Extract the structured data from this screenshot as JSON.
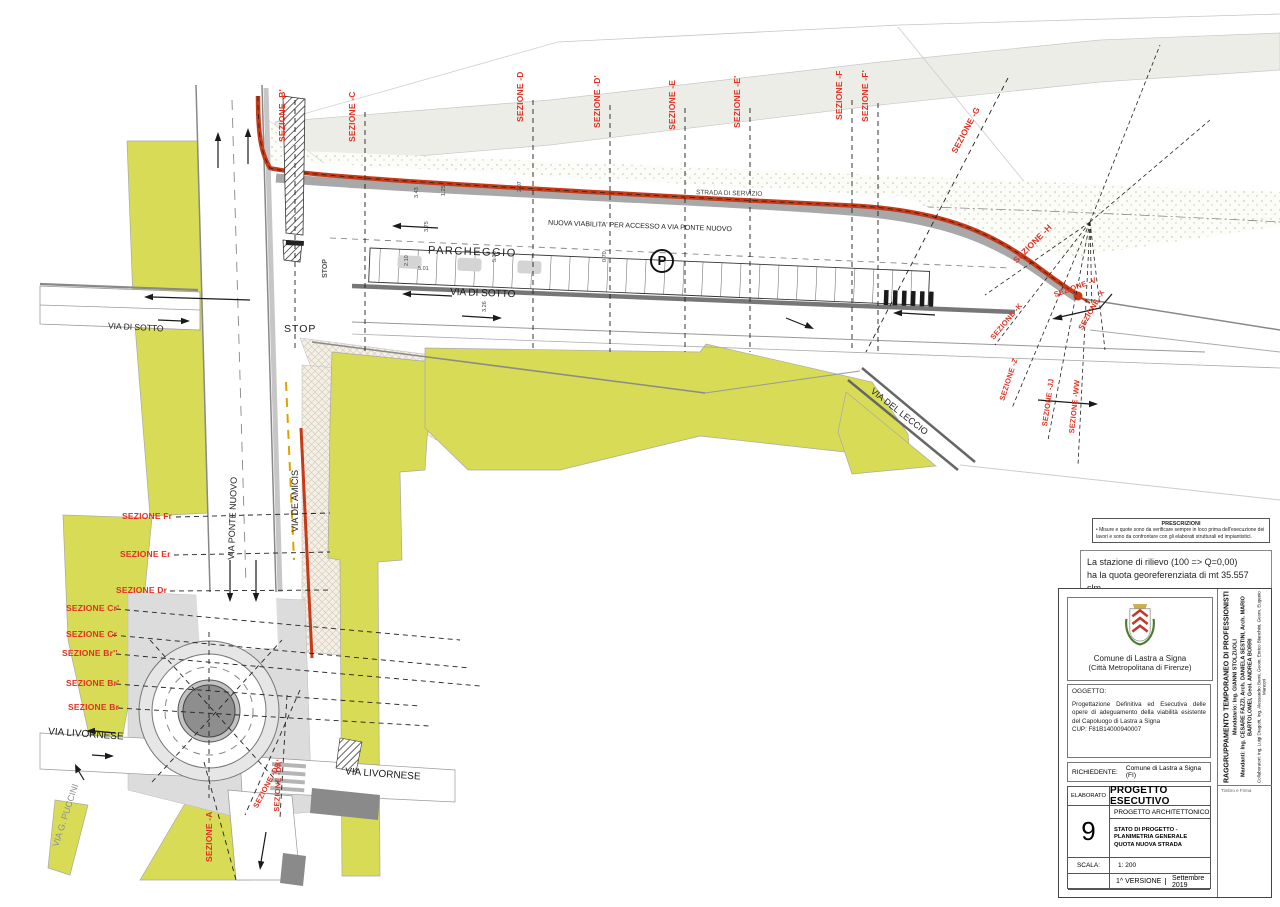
{
  "colors": {
    "section_red": "#e03224",
    "new_road_red": "#c63a17",
    "parcel_yellow": "#d7db55",
    "road_gray": "#a8a8a8",
    "terrain_gray": "#ededE8"
  },
  "streets": {
    "via_di_sotto": "VIA DI SOTTO",
    "stop": "STOP",
    "via_ponte_nuovo": "VIA PONTE NUOVO",
    "via_de_amicis": "VIA DE AMICIS",
    "strada_di_servizio": "STRADA DI SERVIZIO",
    "nuova_viabilita": "NUOVA VIABILITA' PER ACCESSO A VIA PONTE NUOVO",
    "parcheggio": "PARCHEGGIO",
    "parking_symbol": "P",
    "via_del_leccio": "VIA DEL LECCIO",
    "via_livornese": "VIA LIVORNESE",
    "via_g_puccini": "VIA G. PUCCINI"
  },
  "sections": {
    "top": [
      "SEZIONE -B'",
      "SEZIONE -C",
      "SEZIONE -D",
      "SEZIONE -D'",
      "SEZIONE -E",
      "SEZIONE -E'",
      "SEZIONE -F",
      "SEZIONE -F'",
      "SEZIONE -G"
    ],
    "right": [
      "SEZIONE -H",
      "SEZIONE -V",
      "SEZIONE -X",
      "SEZIONE -K",
      "SEZIONE -Z",
      "SEZIONE -JJ",
      "SEZIONE -WW"
    ],
    "left": [
      "SEZIONE Fr",
      "SEZIONE Er",
      "SEZIONE Dr",
      "SEZIONE Cr'",
      "SEZIONE Cr",
      "SEZIONE Br''",
      "SEZIONE Br'",
      "SEZIONE Br"
    ],
    "bottom": [
      "SEZIONE -A",
      "SEZIONE -DE",
      "SEZIONE -DA'"
    ]
  },
  "dimensions": [
    "3.43",
    "1.25",
    "2.07",
    "3.75",
    "2.10",
    "5.01",
    "5.36",
    "0.70",
    "3.26"
  ],
  "notes": {
    "prescrizioni_title": "PRESCRIZIONI",
    "prescrizioni_body": "• Misure e quote sono da verificare sempre in loco prima dell'esecuzione dei lavori e sono da confrontare con gli elaborati strutturali ed impiantistici.",
    "station_line1": "La stazione di rilievo (100 => Q=0,00)",
    "station_line2": "ha la quota georeferenziata di mt 35.557 slm"
  },
  "title_block": {
    "municipality": "Comune di Lastra a Signa",
    "municipality_sub": "(Città Metropolitana di Firenze)",
    "oggetto_label": "OGGETTO:",
    "oggetto_text": "Progettazione Definitiva ed Esecutiva delle opere di adeguamento della viabilità esistente del Capoluogo di Lastra a Signa",
    "cup": "CUP: F81B14000940007",
    "richiedente_label": "RICHIEDENTE:",
    "richiedente_value": "Comune di Lastra a Signa  (FI)",
    "elaborato_label": "ELABORATO",
    "project_title": "PROGETTO ESECUTIVO",
    "project_subtitle": "PROGETTO ARCHITETTONICO",
    "sheet_number": "9",
    "sheet_title_lines": [
      "STATO DI PROGETTO -",
      "PLANIMETRIA GENERALE",
      "QUOTA NUOVA STRADA"
    ],
    "scala_label": "SCALA:",
    "scala_value": "1: 200",
    "version": "1^ VERSIONE",
    "date": "Settembre 2019",
    "team": [
      "RAGGRUPPAMENTO TEMPORANEO DI PROFESSIONISTI",
      "Mandatario: Ing. GIANNI STOLZUOLI",
      "Mandanti: Ing. CESARE FAZZI, Arch. DANIELA SESTINI, Arch. MARIO BARTOLOMEI, Geol. ANDREA BORRI",
      "Collaboratori: Ing. Luigi Dragotti, Ing. Alessandro Berni, Geom. Enrico Bianchini, Geom. Eugenio Mancori"
    ],
    "timbro": "Timbro e Firma"
  }
}
